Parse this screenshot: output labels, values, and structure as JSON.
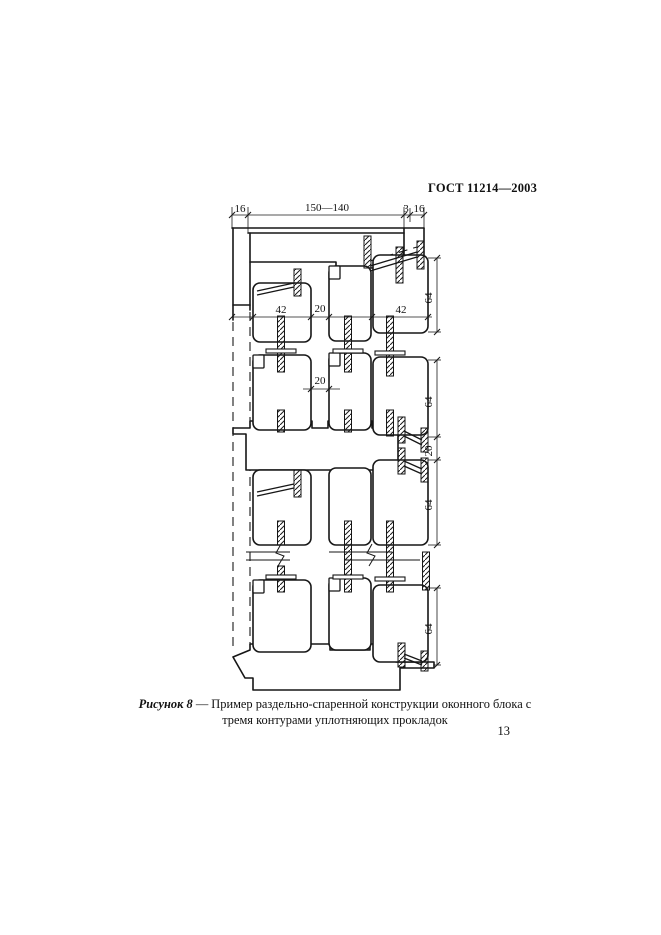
{
  "page": {
    "header": "ГОСТ 11214—2003",
    "page_number": "13"
  },
  "figure": {
    "caption_label": "Рисунок 8",
    "caption_line1": "— Пример раздельно-спаренной конструкции оконного блока с",
    "caption_line2": "тремя контурами уплотняющих прокладок",
    "dims": {
      "top_left": "16",
      "top_span": "150—140",
      "top_gap": "3",
      "top_right": "16",
      "row1_left": "42",
      "row1_mid": "20",
      "row1_right": "42",
      "row2_mid": "20",
      "v1": "64",
      "v2": "64",
      "v3": "20",
      "v4": "64",
      "v5": "64"
    }
  }
}
